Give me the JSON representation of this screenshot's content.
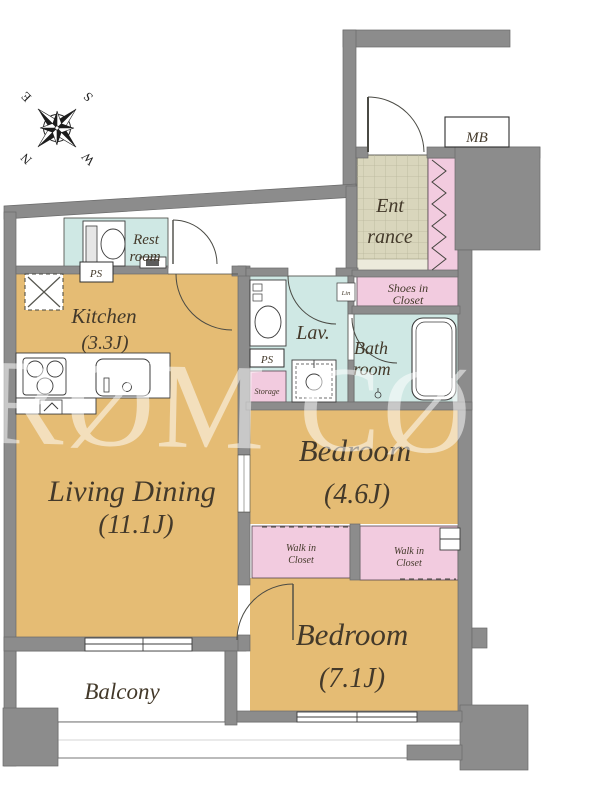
{
  "title": "apartment-floor-plan",
  "watermark": "RØM CØPY",
  "compass": {
    "n": "N",
    "e": "E",
    "s": "S",
    "w": "W"
  },
  "labels": {
    "rest_room": [
      "Rest",
      "room"
    ],
    "kitchen": [
      "Kitchen",
      "(3.3J)"
    ],
    "living_dining": [
      "Living Dining",
      "(11.1J)"
    ],
    "entrance": [
      "Ent",
      "rance"
    ],
    "shoes_closet": [
      "Shoes in",
      "Closet"
    ],
    "lavatory": "Lav.",
    "bath_room": [
      "Bath",
      "room"
    ],
    "bedroom_1": [
      "Bedroom",
      "(4.6J)"
    ],
    "bedroom_2": [
      "Bedroom",
      "(7.1J)"
    ],
    "walk_in_closet": [
      "Walk in",
      "Closet"
    ],
    "balcony": "Balcony",
    "storage": "Storage",
    "linen": "Lin",
    "meter_box": "MB",
    "pipe_space": "PS"
  },
  "colors": {
    "wall_gray": "#8c8c8c",
    "floor_tan": "#e5bc74",
    "wet_area_teal": "#cfe8e4",
    "closet_pink": "#f2cbdf",
    "entrance_tile": "#d9d6bc",
    "label_text": "#43392a",
    "watermark": "rgba(255,255,255,0.52)"
  }
}
